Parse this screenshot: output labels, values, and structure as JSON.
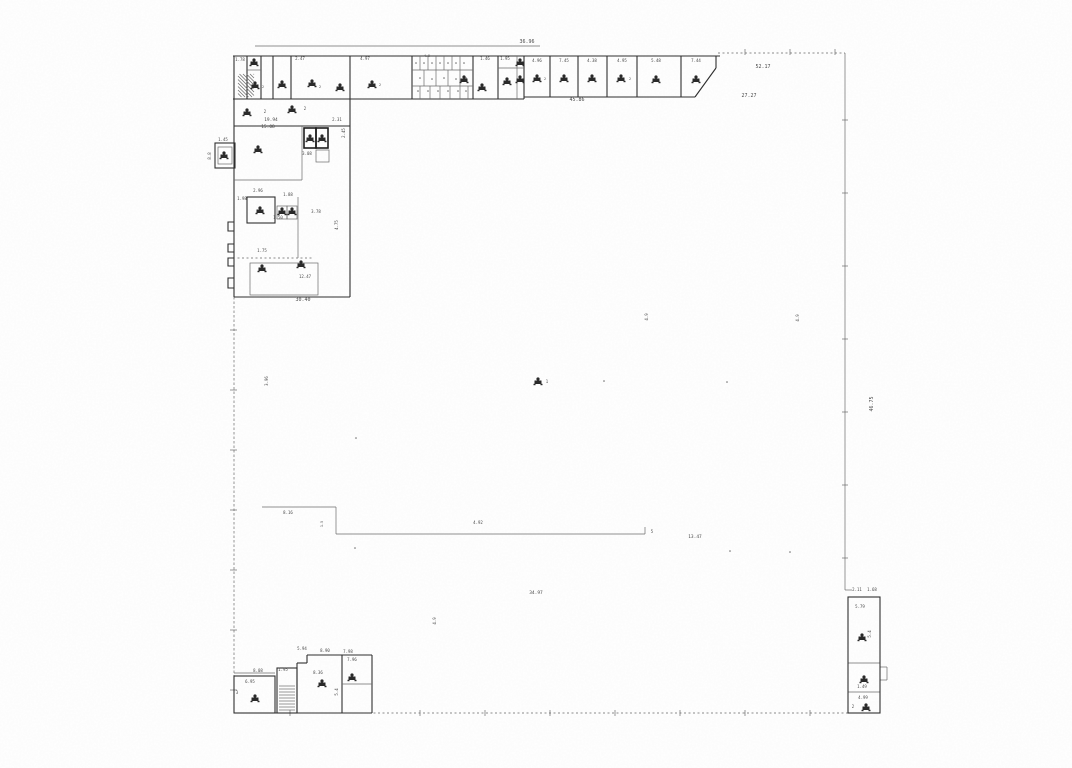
{
  "page": {
    "width": 1072,
    "height": 768,
    "background": "#ffffff"
  },
  "plan": {
    "description_label": "scanned-architectural-floor-plan",
    "colors": {
      "paper": "#ffffff",
      "ink": "#2e2e2e",
      "thin": "#6b6b6b",
      "dash": "#8a8a8a",
      "bold": "#1f1f1f",
      "label": "#4a4a4a",
      "fixture": "#2a2a2a"
    },
    "lines": [
      [
        255,
        46,
        540,
        46,
        "thin"
      ],
      [
        233,
        56,
        720,
        56,
        "wall"
      ],
      [
        718,
        53,
        845,
        53,
        "dash"
      ],
      [
        845,
        53,
        845,
        590,
        "thin"
      ],
      [
        234,
        713,
        848,
        713,
        "dash"
      ],
      [
        234,
        56,
        234,
        297,
        "wall"
      ],
      [
        234,
        297,
        234,
        713,
        "dashdot"
      ],
      [
        233,
        99,
        524,
        99,
        "wall"
      ],
      [
        247,
        56,
        247,
        99,
        "wall"
      ],
      [
        261,
        56,
        261,
        99,
        "wall"
      ],
      [
        273,
        56,
        273,
        99,
        "wall"
      ],
      [
        291,
        56,
        291,
        99,
        "wall"
      ],
      [
        350,
        56,
        350,
        297,
        "wall"
      ],
      [
        412,
        56,
        412,
        99,
        "wall"
      ],
      [
        473,
        56,
        473,
        99,
        "wall"
      ],
      [
        498,
        56,
        498,
        99,
        "wall"
      ],
      [
        517,
        56,
        517,
        99,
        "thin"
      ],
      [
        524,
        56,
        524,
        99,
        "wall"
      ],
      [
        247,
        70,
        261,
        70,
        "thin"
      ],
      [
        498,
        68,
        524,
        68,
        "thin"
      ],
      [
        412,
        70,
        473,
        70,
        "thin"
      ],
      [
        412,
        86,
        473,
        86,
        "thin"
      ],
      [
        420,
        56,
        420,
        70,
        "thin"
      ],
      [
        428,
        56,
        428,
        70,
        "thin"
      ],
      [
        436,
        56,
        436,
        70,
        "thin"
      ],
      [
        444,
        56,
        444,
        70,
        "thin"
      ],
      [
        452,
        56,
        452,
        70,
        "thin"
      ],
      [
        460,
        56,
        460,
        70,
        "thin"
      ],
      [
        424,
        70,
        424,
        86,
        "thin"
      ],
      [
        436,
        70,
        436,
        86,
        "thin"
      ],
      [
        448,
        70,
        448,
        86,
        "thin"
      ],
      [
        460,
        70,
        460,
        86,
        "thin"
      ],
      [
        420,
        86,
        420,
        99,
        "thin"
      ],
      [
        430,
        86,
        430,
        99,
        "thin"
      ],
      [
        440,
        86,
        440,
        99,
        "thin"
      ],
      [
        450,
        86,
        450,
        99,
        "thin"
      ],
      [
        460,
        86,
        460,
        99,
        "thin"
      ],
      [
        468,
        86,
        468,
        99,
        "thin"
      ],
      [
        524,
        97,
        695,
        97,
        "wall"
      ],
      [
        695,
        97,
        716,
        68,
        "wall"
      ],
      [
        716,
        68,
        716,
        56,
        "wall"
      ],
      [
        550,
        56,
        550,
        97,
        "wall"
      ],
      [
        578,
        56,
        578,
        97,
        "wall"
      ],
      [
        607,
        56,
        607,
        97,
        "wall"
      ],
      [
        637,
        56,
        637,
        97,
        "wall"
      ],
      [
        681,
        56,
        681,
        97,
        "wall"
      ],
      [
        234,
        126,
        350,
        126,
        "wall"
      ],
      [
        234,
        180,
        302,
        180,
        "thin"
      ],
      [
        302,
        126,
        302,
        180,
        "thin"
      ],
      [
        298,
        197,
        298,
        258,
        "thin"
      ],
      [
        233,
        258,
        313,
        258,
        "dash"
      ],
      [
        234,
        297,
        350,
        297,
        "wall"
      ],
      [
        262,
        507,
        336,
        507,
        "thin"
      ],
      [
        336,
        507,
        336,
        534,
        "thin"
      ],
      [
        336,
        534,
        645,
        534,
        "thin"
      ],
      [
        645,
        534,
        645,
        527,
        "thin"
      ],
      [
        234,
        673,
        275,
        673,
        "thin"
      ],
      [
        297,
        663,
        307,
        663,
        "wall"
      ],
      [
        307,
        663,
        307,
        655,
        "wall"
      ],
      [
        307,
        655,
        372,
        655,
        "wall"
      ],
      [
        297,
        663,
        297,
        713,
        "wall"
      ],
      [
        342,
        655,
        342,
        713,
        "wall"
      ],
      [
        372,
        655,
        372,
        713,
        "wall"
      ],
      [
        342,
        684,
        372,
        684,
        "thin"
      ],
      [
        234,
        713,
        372,
        713,
        "wall"
      ],
      [
        848,
        663,
        880,
        663,
        "thin"
      ],
      [
        848,
        692,
        880,
        692,
        "thin"
      ],
      [
        880,
        667,
        887,
        667,
        "thin"
      ],
      [
        887,
        667,
        887,
        680,
        "thin"
      ],
      [
        880,
        680,
        887,
        680,
        "thin"
      ],
      [
        845,
        590,
        852,
        590,
        "thin"
      ],
      [
        230,
        330,
        237,
        330,
        "thin"
      ],
      [
        230,
        390,
        237,
        390,
        "thin"
      ],
      [
        230,
        450,
        237,
        450,
        "thin"
      ],
      [
        230,
        510,
        237,
        510,
        "thin"
      ],
      [
        230,
        570,
        237,
        570,
        "thin"
      ],
      [
        230,
        630,
        237,
        630,
        "thin"
      ],
      [
        230,
        690,
        237,
        690,
        "thin"
      ],
      [
        290,
        710,
        290,
        716,
        "thin"
      ],
      [
        420,
        710,
        420,
        716,
        "thin"
      ],
      [
        485,
        710,
        485,
        716,
        "thin"
      ],
      [
        550,
        710,
        550,
        716,
        "thin"
      ],
      [
        615,
        710,
        615,
        716,
        "thin"
      ],
      [
        680,
        710,
        680,
        716,
        "thin"
      ],
      [
        745,
        710,
        745,
        716,
        "thin"
      ],
      [
        810,
        710,
        810,
        716,
        "thin"
      ],
      [
        842,
        120,
        848,
        120,
        "thin"
      ],
      [
        842,
        193,
        848,
        193,
        "thin"
      ],
      [
        842,
        266,
        848,
        266,
        "thin"
      ],
      [
        842,
        339,
        848,
        339,
        "thin"
      ],
      [
        842,
        412,
        848,
        412,
        "thin"
      ],
      [
        842,
        485,
        848,
        485,
        "thin"
      ],
      [
        842,
        558,
        848,
        558,
        "thin"
      ],
      [
        745,
        49,
        745,
        55,
        "thin"
      ],
      [
        790,
        49,
        790,
        55,
        "thin"
      ],
      [
        835,
        49,
        835,
        55,
        "thin"
      ]
    ],
    "rects": [
      [
        234,
        676,
        41,
        37,
        "wall"
      ],
      [
        277,
        668,
        20,
        45,
        "wall"
      ],
      [
        304,
        128,
        12,
        20,
        "bold"
      ],
      [
        316,
        128,
        12,
        20,
        "bold"
      ],
      [
        316,
        150,
        13,
        12,
        "thin"
      ],
      [
        247,
        197,
        28,
        26,
        "wall"
      ],
      [
        277,
        206,
        10,
        13,
        "thin"
      ],
      [
        287,
        206,
        10,
        13,
        "thin"
      ],
      [
        250,
        263,
        68,
        32,
        "thin"
      ],
      [
        215,
        143,
        20,
        25,
        "wall"
      ],
      [
        218,
        147,
        14,
        17,
        "thin"
      ],
      [
        848,
        597,
        32,
        116,
        "wall"
      ]
    ],
    "polylines": [
      [
        "234,222 228,222 228,231 234,231",
        "wall"
      ],
      [
        "234,244 228,244 228,252 234,252",
        "wall"
      ],
      [
        "234,258 228,258 228,266 234,266",
        "wall"
      ],
      [
        "234,278 228,278 228,288 234,288",
        "wall"
      ]
    ],
    "hatches": [
      [
        238,
        74,
        16,
        23,
        "diag",
        3.5
      ],
      [
        279,
        686,
        16,
        26,
        "horiz",
        3
      ]
    ],
    "labels": [
      [
        527,
        43,
        "36.96",
        5,
        0
      ],
      [
        577,
        101,
        "45.86",
        5,
        0
      ],
      [
        763,
        68,
        "52.17",
        5,
        0
      ],
      [
        749,
        97,
        "27.27",
        5,
        0
      ],
      [
        873,
        404,
        "46.75",
        5,
        -90
      ],
      [
        303,
        301,
        "30.40",
        5,
        0
      ],
      [
        271,
        121,
        "19.94",
        4.5,
        0
      ],
      [
        268,
        128,
        "15.08",
        4.5,
        0
      ],
      [
        337,
        121,
        "2.31",
        4,
        0
      ],
      [
        345,
        133,
        "2.45",
        4,
        -90
      ],
      [
        307,
        155,
        "3.08",
        4,
        0
      ],
      [
        223,
        141,
        "1.45",
        4,
        0
      ],
      [
        211,
        156,
        "8.8",
        4,
        -90
      ],
      [
        240,
        61,
        "1.78",
        4,
        0
      ],
      [
        300,
        60,
        "2.47",
        4,
        0
      ],
      [
        365,
        60,
        "4.97",
        4,
        0
      ],
      [
        427,
        57,
        "4.9",
        3.5,
        0
      ],
      [
        485,
        60,
        "1.46",
        4,
        0
      ],
      [
        505,
        60,
        "1.95",
        4,
        0
      ],
      [
        537,
        62,
        "4.96",
        4,
        0
      ],
      [
        564,
        62,
        "7.45",
        4,
        0
      ],
      [
        592,
        62,
        "4.38",
        4,
        0
      ],
      [
        622,
        62,
        "4.95",
        4,
        0
      ],
      [
        656,
        62,
        "5.48",
        4,
        0
      ],
      [
        696,
        62,
        "7.44",
        4,
        0
      ],
      [
        268,
        381,
        "3.96",
        4,
        -90
      ],
      [
        436,
        621,
        "4.9",
        4,
        -90
      ],
      [
        648,
        317,
        "4.9",
        4,
        -90
      ],
      [
        799,
        318,
        "4.9",
        4,
        -90
      ],
      [
        288,
        514,
        "8.16",
        4,
        0
      ],
      [
        478,
        524,
        "4.92",
        4,
        0
      ],
      [
        652,
        533,
        "5",
        4,
        0
      ],
      [
        695,
        538,
        "13.47",
        4.5,
        0
      ],
      [
        536,
        594,
        "34.97",
        4.5,
        0
      ],
      [
        323,
        524,
        "1.5",
        3.5,
        -90
      ],
      [
        258,
        672,
        "8.08",
        4,
        0
      ],
      [
        250,
        683,
        "6.95",
        4,
        0
      ],
      [
        283,
        671,
        "1.95",
        4,
        0
      ],
      [
        302,
        650,
        "5.94",
        4,
        0
      ],
      [
        325,
        652,
        "8.90",
        4,
        0
      ],
      [
        348,
        653,
        "7.98",
        4,
        0
      ],
      [
        318,
        674,
        "8.36",
        4,
        0
      ],
      [
        352,
        661,
        "7.96",
        4,
        0
      ],
      [
        338,
        692,
        "5.4",
        4,
        -90
      ],
      [
        237,
        694,
        "3",
        4,
        0
      ],
      [
        857,
        591,
        "2.11",
        4,
        0
      ],
      [
        872,
        591,
        "1.68",
        4,
        0
      ],
      [
        860,
        608,
        "5.79",
        4,
        0
      ],
      [
        862,
        688,
        "1.49",
        4,
        0
      ],
      [
        863,
        699,
        "4.99",
        4,
        0
      ],
      [
        853,
        708,
        "2",
        4,
        0
      ],
      [
        871,
        634,
        "5.4",
        4,
        -90
      ],
      [
        288,
        196,
        "1.88",
        4,
        0
      ],
      [
        258,
        192,
        "2.96",
        4,
        0
      ],
      [
        242,
        200,
        "1.98",
        4,
        0
      ],
      [
        278,
        219,
        "1.50",
        4,
        0
      ],
      [
        316,
        213,
        "3.78",
        4,
        0
      ],
      [
        338,
        225,
        "4.75",
        4,
        -90
      ],
      [
        262,
        252,
        "1.75",
        4,
        0
      ],
      [
        305,
        278,
        "12.47",
        4,
        0
      ],
      [
        265,
        113,
        "2",
        4,
        0
      ],
      [
        305,
        110,
        "2",
        4,
        0
      ],
      [
        547,
        383,
        "1",
        4,
        0
      ],
      [
        263,
        88,
        "2",
        3.5,
        0
      ],
      [
        320,
        88,
        "2",
        3.5,
        0
      ],
      [
        380,
        86,
        "2",
        3.5,
        0
      ],
      [
        545,
        80,
        "2",
        3.5,
        0
      ],
      [
        630,
        80,
        "2",
        3.5,
        0
      ]
    ],
    "fixtures": [
      [
        254,
        63
      ],
      [
        255,
        86
      ],
      [
        282,
        85
      ],
      [
        312,
        84
      ],
      [
        340,
        88
      ],
      [
        372,
        85
      ],
      [
        464,
        80
      ],
      [
        482,
        88
      ],
      [
        507,
        82
      ],
      [
        520,
        63
      ],
      [
        520,
        80
      ],
      [
        537,
        79
      ],
      [
        564,
        79
      ],
      [
        592,
        79
      ],
      [
        621,
        79
      ],
      [
        656,
        80
      ],
      [
        696,
        80
      ],
      [
        247,
        113
      ],
      [
        292,
        110
      ],
      [
        258,
        150
      ],
      [
        310,
        139
      ],
      [
        322,
        139
      ],
      [
        260,
        211
      ],
      [
        282,
        212
      ],
      [
        292,
        212
      ],
      [
        224,
        156
      ],
      [
        262,
        269
      ],
      [
        301,
        265
      ],
      [
        538,
        382
      ],
      [
        255,
        699
      ],
      [
        322,
        684
      ],
      [
        352,
        678
      ],
      [
        862,
        638
      ],
      [
        864,
        680
      ],
      [
        866,
        708
      ]
    ],
    "dots": [
      [
        356,
        438
      ],
      [
        604,
        381
      ],
      [
        727,
        382
      ],
      [
        730,
        551
      ],
      [
        355,
        548
      ],
      [
        790,
        552
      ],
      [
        416,
        63
      ],
      [
        424,
        63
      ],
      [
        432,
        63
      ],
      [
        440,
        63
      ],
      [
        448,
        63
      ],
      [
        456,
        63
      ],
      [
        464,
        63
      ],
      [
        418,
        91
      ],
      [
        428,
        91
      ],
      [
        438,
        91
      ],
      [
        448,
        91
      ],
      [
        458,
        91
      ],
      [
        466,
        91
      ],
      [
        420,
        78
      ],
      [
        432,
        79
      ],
      [
        444,
        78
      ],
      [
        456,
        79
      ],
      [
        466,
        78
      ]
    ]
  }
}
